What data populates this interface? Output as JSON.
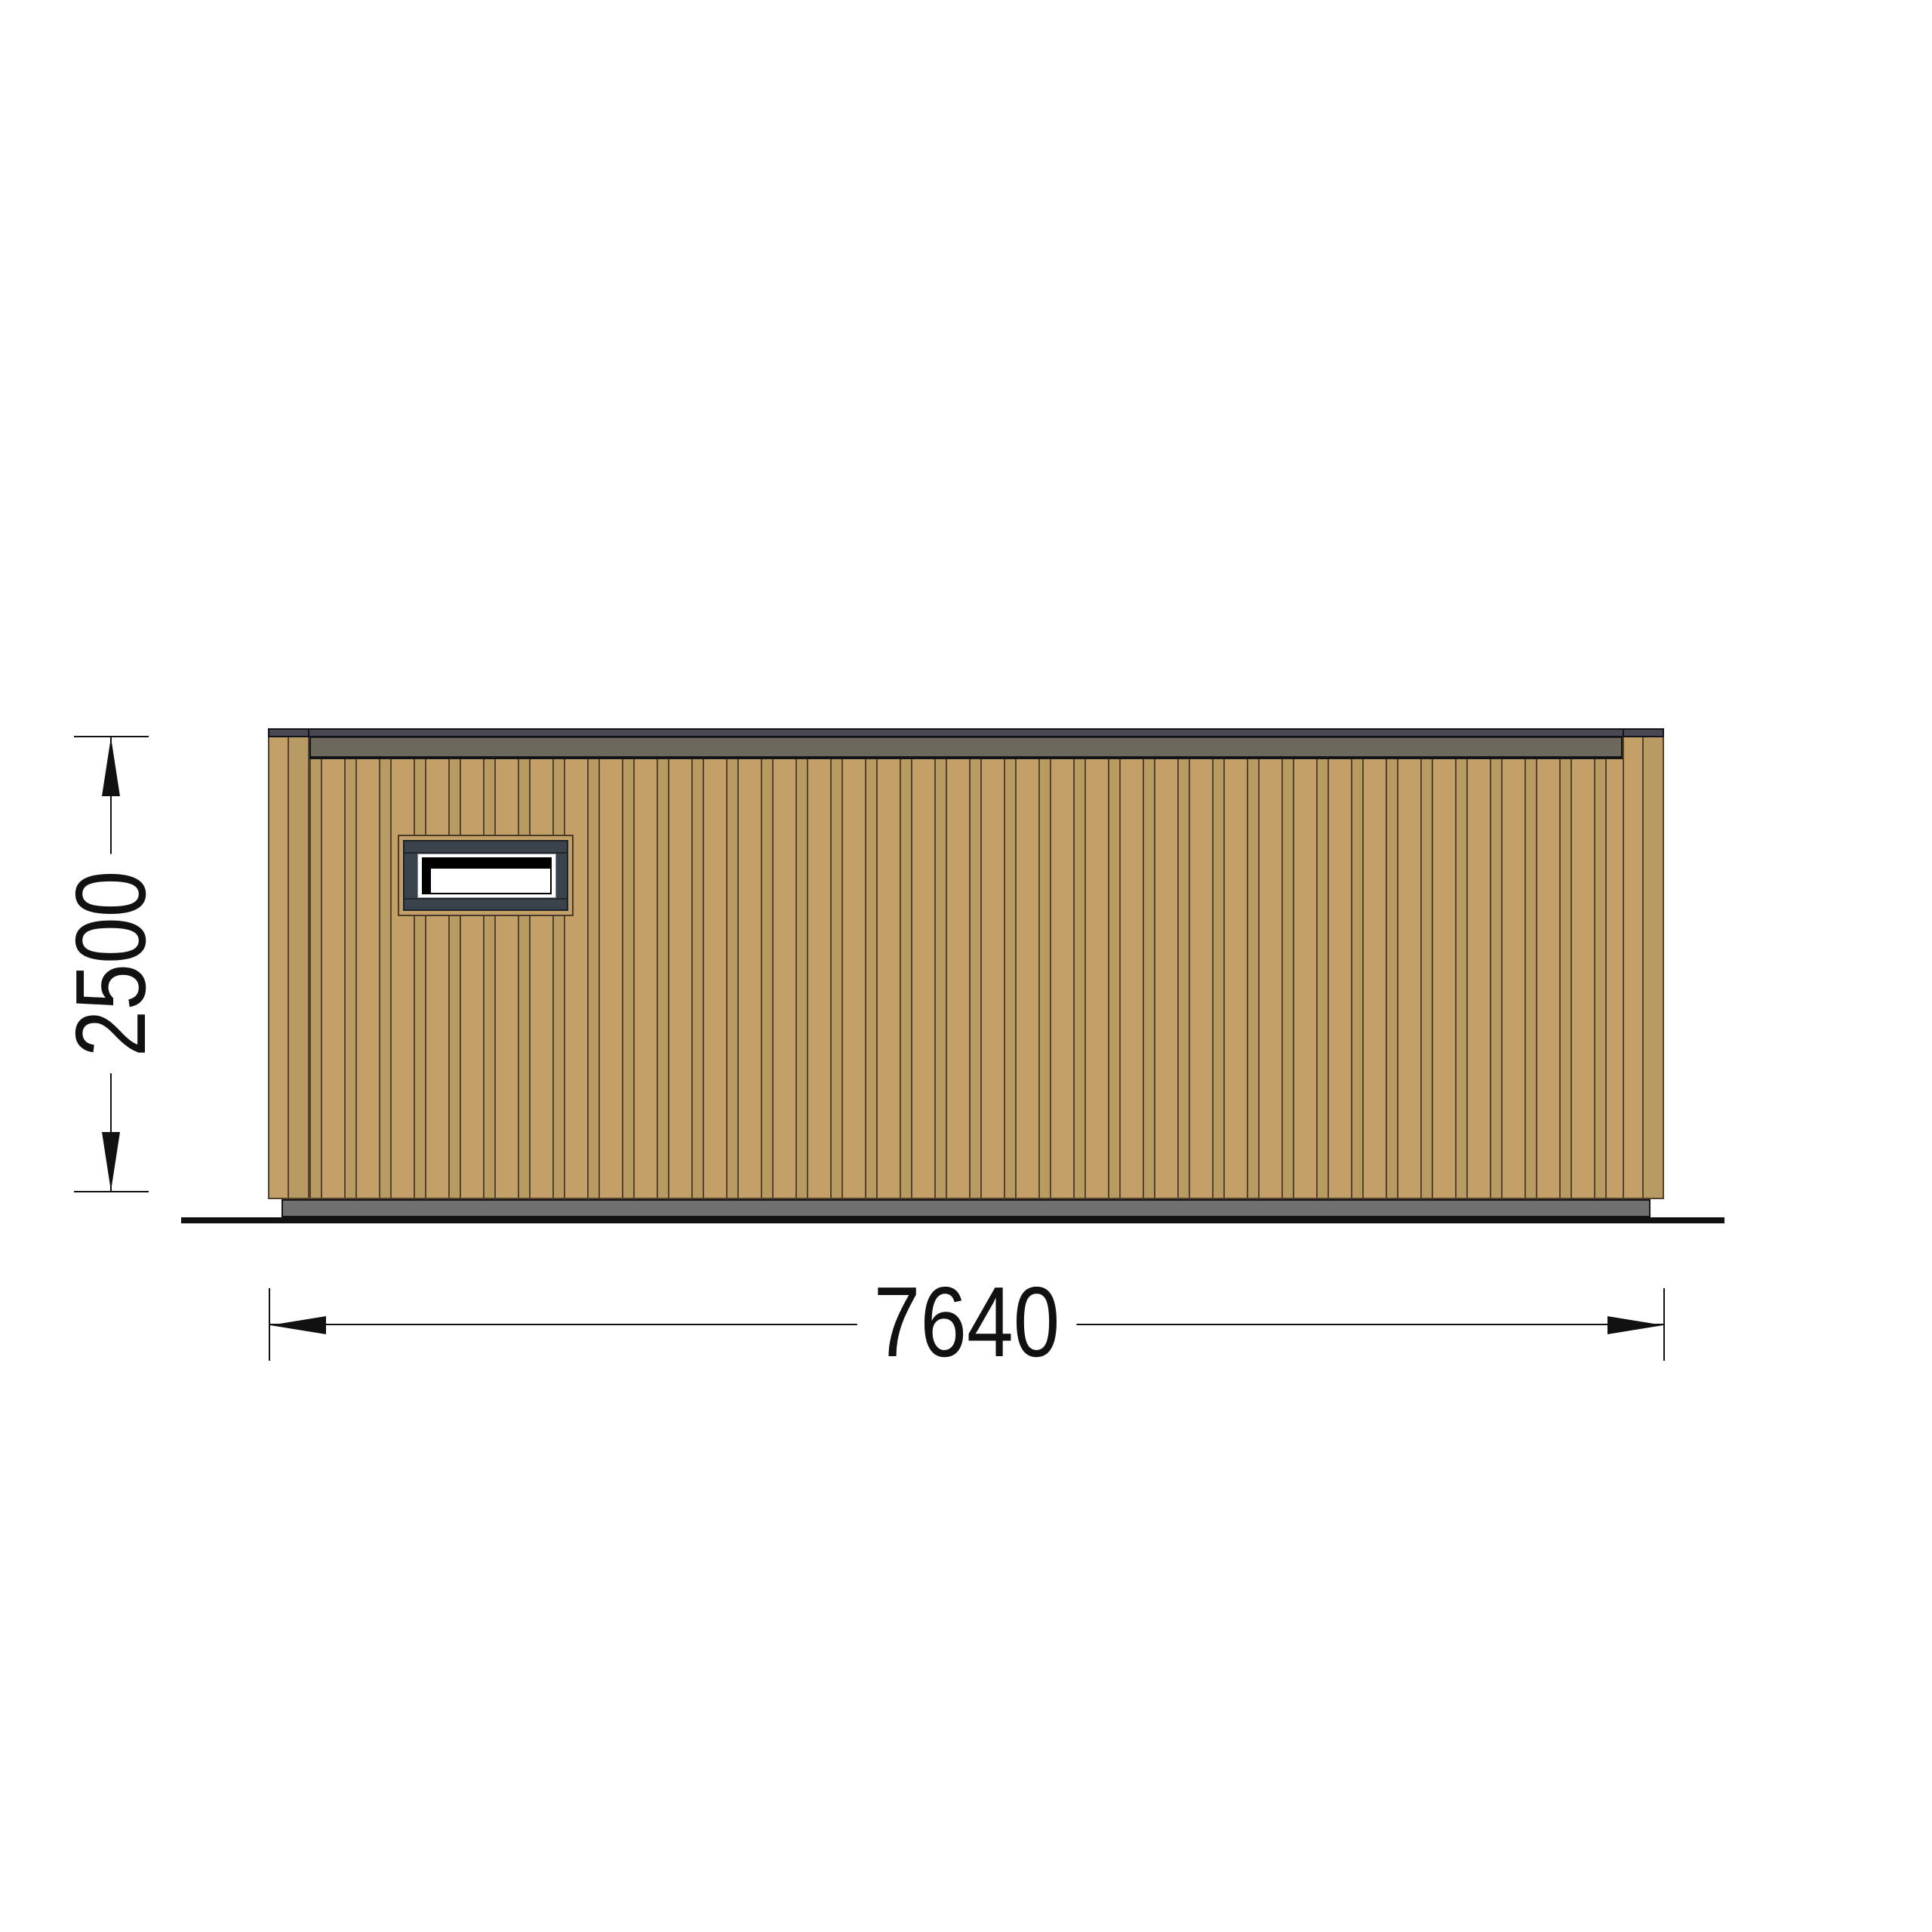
{
  "drawing": {
    "title": "timber-cabin-side-elevation",
    "dimensions": {
      "height": {
        "label": "2500"
      },
      "width": {
        "label": "7640"
      }
    }
  },
  "colors": {
    "paper": "#ffffff",
    "wood": "#c2a068",
    "wood_dark": "#b89a63",
    "seam": "#54422c",
    "roof_edge": "#474851",
    "fascia": "#6c685c",
    "base": "#707070",
    "window_frame": "#3a424b",
    "glazing": "#000000",
    "trim_line": "#4a3927",
    "outline": "#131417",
    "dim": "#111111"
  }
}
